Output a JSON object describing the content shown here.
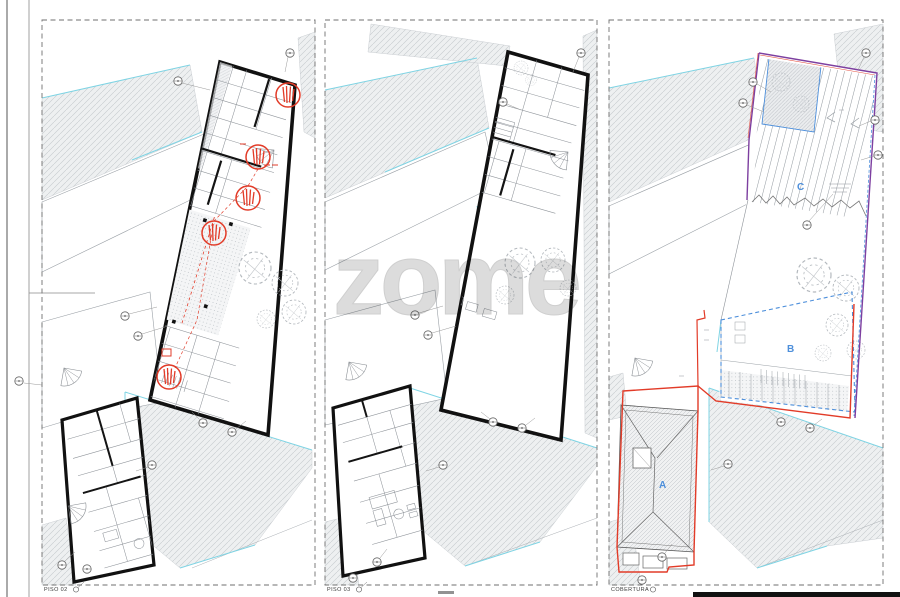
{
  "sheet": {
    "watermark": "zome",
    "panels": [
      {
        "id": "piso-02",
        "label": "PISO 02"
      },
      {
        "id": "piso-03",
        "label": "PISO 03"
      },
      {
        "id": "cobertura",
        "label": "COBERTURA"
      }
    ],
    "zones": {
      "a": "A",
      "b": "B",
      "c": "C"
    },
    "colors": {
      "paper": "#ffffff",
      "wall_black": "#111111",
      "context_fill": "#eef0f1",
      "hatch_line": "#c6cacd",
      "thin_line": "#8a8f94",
      "cyan_boundary": "#7fd4e4",
      "revision_red": "#e23b28",
      "zone_blue": "#4d8fdb",
      "parcel_purple": "#7d3fa0",
      "watermark_gray": "#dcdcdc",
      "border_dash": "#6f6f6f"
    }
  }
}
